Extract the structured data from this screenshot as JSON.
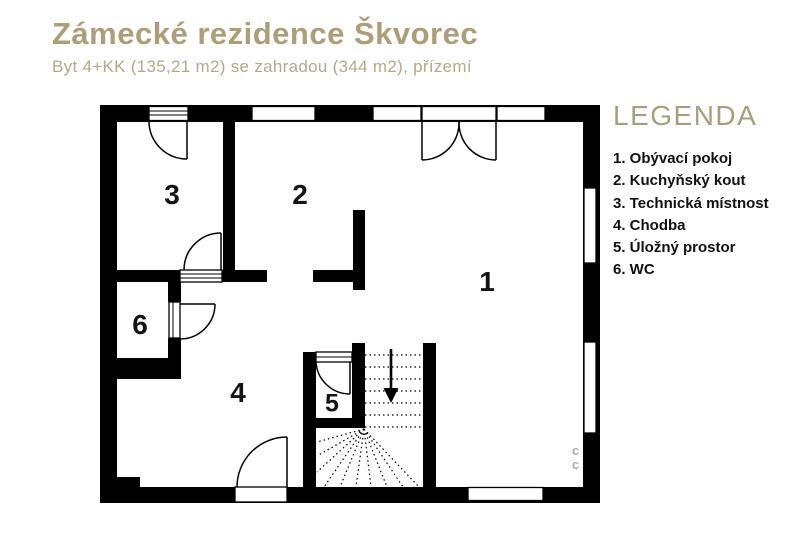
{
  "header": {
    "title": "Zámecké rezidence Škvorec",
    "subtitle": "Byt 4+KK (135,21 m2) se zahradou (344 m2), přízemí"
  },
  "legend": {
    "heading": "LEGENDA",
    "items": [
      "1. Obývací pokoj",
      "2. Kuchyňský kout",
      "3. Technická místnost",
      "4. Chodba",
      "5. Úložný prostor",
      "6. WC"
    ]
  },
  "rooms": [
    {
      "number": "1",
      "name": "Obývací pokoj"
    },
    {
      "number": "2",
      "name": "Kuchyňský kout"
    },
    {
      "number": "3",
      "name": "Technická místnost"
    },
    {
      "number": "4",
      "name": "Chodba"
    },
    {
      "number": "5",
      "name": "Úložný prostor"
    },
    {
      "number": "6",
      "name": "WC"
    }
  ],
  "floor_plan": {
    "stair_arrow_direction": "down",
    "entrance_doors": 3,
    "windows": 6
  },
  "watermark": {
    "mark": "c"
  },
  "colors": {
    "accent": "#ac9f78",
    "accent_light": "#b2aa87",
    "wall": "#000000",
    "background": "#ffffff"
  }
}
